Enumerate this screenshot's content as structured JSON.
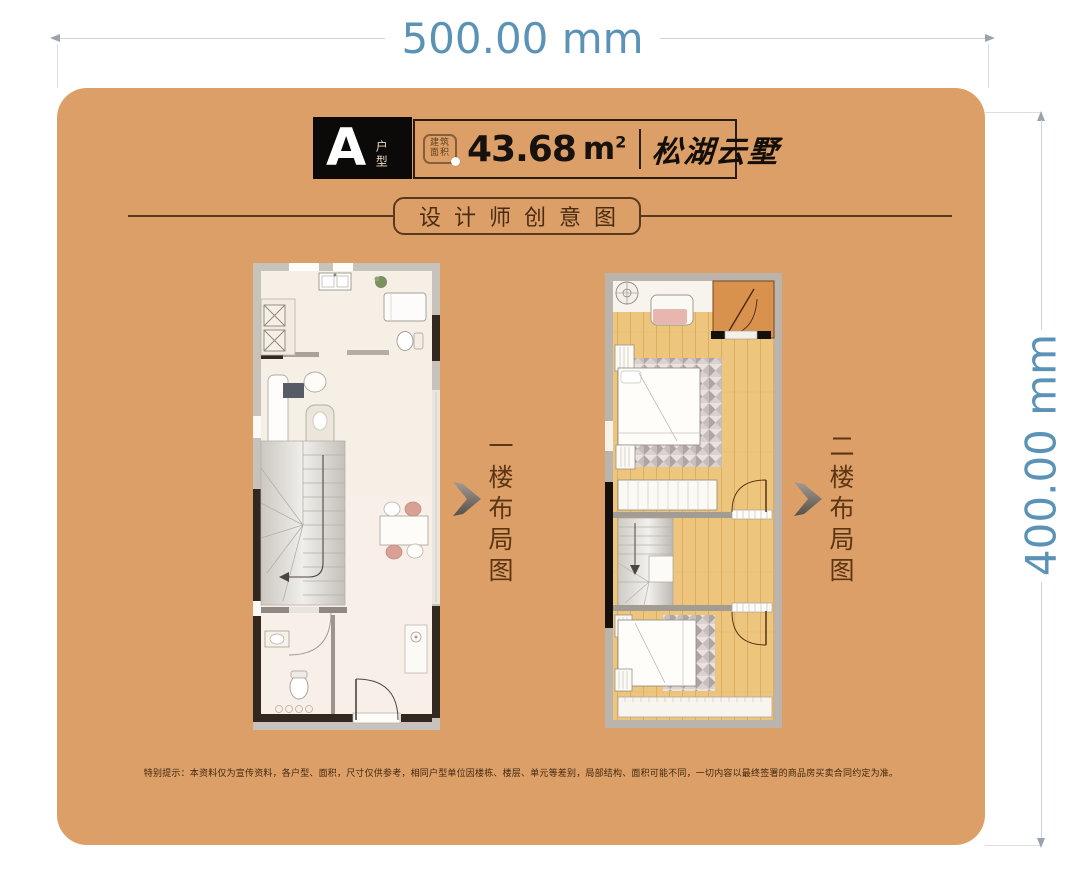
{
  "dimensions": {
    "width_label": "500.00 mm",
    "height_label": "400.00 mm"
  },
  "header": {
    "unit_letter": "A",
    "unit_type": "户型",
    "stamp_line1": "建筑",
    "stamp_line2": "面积",
    "area_value": "43.68",
    "area_unit": "m",
    "area_sup": "2",
    "project_name": "松湖云墅"
  },
  "section_title": "设计师创意图",
  "floors": {
    "first_label": "一楼布局图",
    "second_label": "二楼布局图"
  },
  "disclaimer": "特别提示：本资料仅为宣传资料，各户型、面积，尺寸仅供参考，相同户型单位因楼栋、楼层、单元等差别，局部结构、面积可能不同，一切内容以最终签署的商品房买卖合同约定为准。",
  "colors": {
    "card_bg": "#dd9f68",
    "page_bg": "#ffffff",
    "dim_text": "#5b93b7",
    "dim_line": "#cdd3d7",
    "brown": "#4a2c12",
    "label_brown": "#5c3513",
    "badge_bg": "#0c0a09",
    "wood_floor": "#edc57c",
    "plan_floor": "#f6efe6",
    "balcony": "#d8924e"
  }
}
